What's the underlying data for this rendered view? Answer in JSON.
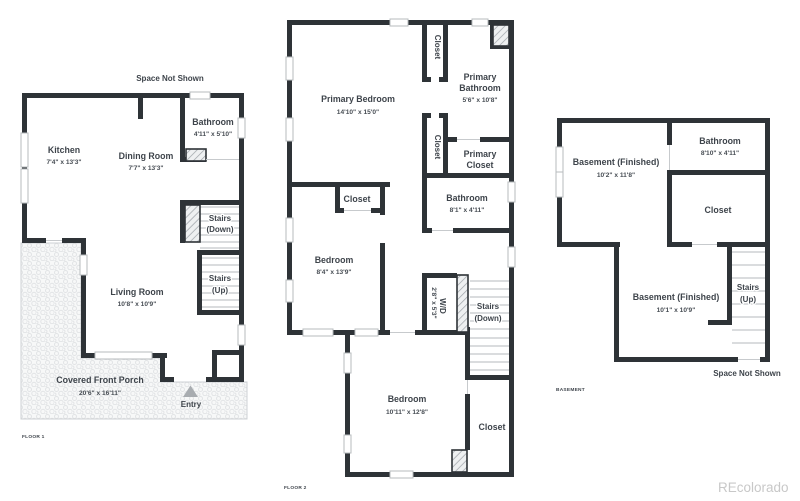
{
  "colors": {
    "wall": "#2e3337",
    "text": "#3e444b",
    "tread": "#c4c7ca",
    "watermark": "#c8c8c8"
  },
  "watermark": "REcolorado",
  "floor1": {
    "title": "FLOOR 1",
    "space_not_shown": "Space Not Shown",
    "kitchen_name": "Kitchen",
    "kitchen_dims": "7'4\" x 13'3\"",
    "dining_name": "Dining Room",
    "dining_dims": "7'7\" x 13'3\"",
    "bathroom_name": "Bathroom",
    "bathroom_dims": "4'11\" x 5'10\"",
    "stairs_down_1": "Stairs",
    "stairs_down_2": "(Down)",
    "stairs_up_1": "Stairs",
    "stairs_up_2": "(Up)",
    "living_name": "Living Room",
    "living_dims": "10'8\" x 10'9\"",
    "porch_name": "Covered Front Porch",
    "porch_dims": "20'6\" x 16'11\"",
    "entry": "Entry"
  },
  "floor2": {
    "title": "FLOOR 2",
    "primary_bedroom_name": "Primary Bedroom",
    "primary_bedroom_dims": "14'10\" x 15'0\"",
    "closet_top": "Closet",
    "primary_bathroom_1": "Primary",
    "primary_bathroom_2": "Bathroom",
    "primary_bathroom_dims": "5'6\" x 10'8\"",
    "closet_mid": "Closet",
    "primary_closet_1": "Primary",
    "primary_closet_2": "Closet",
    "bathroom_name": "Bathroom",
    "bathroom_dims": "8'1\" x 4'11\"",
    "closet_bedroom": "Closet",
    "bedroom2_name": "Bedroom",
    "bedroom2_dims": "8'4\" x 13'9\"",
    "wd_name": "W/D",
    "wd_dims": "2'8\" x 5'3\"",
    "stairs_down_1": "Stairs",
    "stairs_down_2": "(Down)",
    "bedroom3_name": "Bedroom",
    "bedroom3_dims": "10'11\" x 12'8\"",
    "closet_bottom": "Closet"
  },
  "basement": {
    "title": "BASEMENT",
    "space_not_shown": "Space Not Shown",
    "room1_name": "Basement (Finished)",
    "room1_dims": "10'2\" x 11'8\"",
    "bathroom_name": "Bathroom",
    "bathroom_dims": "8'10\" x 4'11\"",
    "closet": "Closet",
    "room2_name": "Basement (Finished)",
    "room2_dims": "10'1\" x 10'9\"",
    "stairs_up_1": "Stairs",
    "stairs_up_2": "(Up)"
  }
}
